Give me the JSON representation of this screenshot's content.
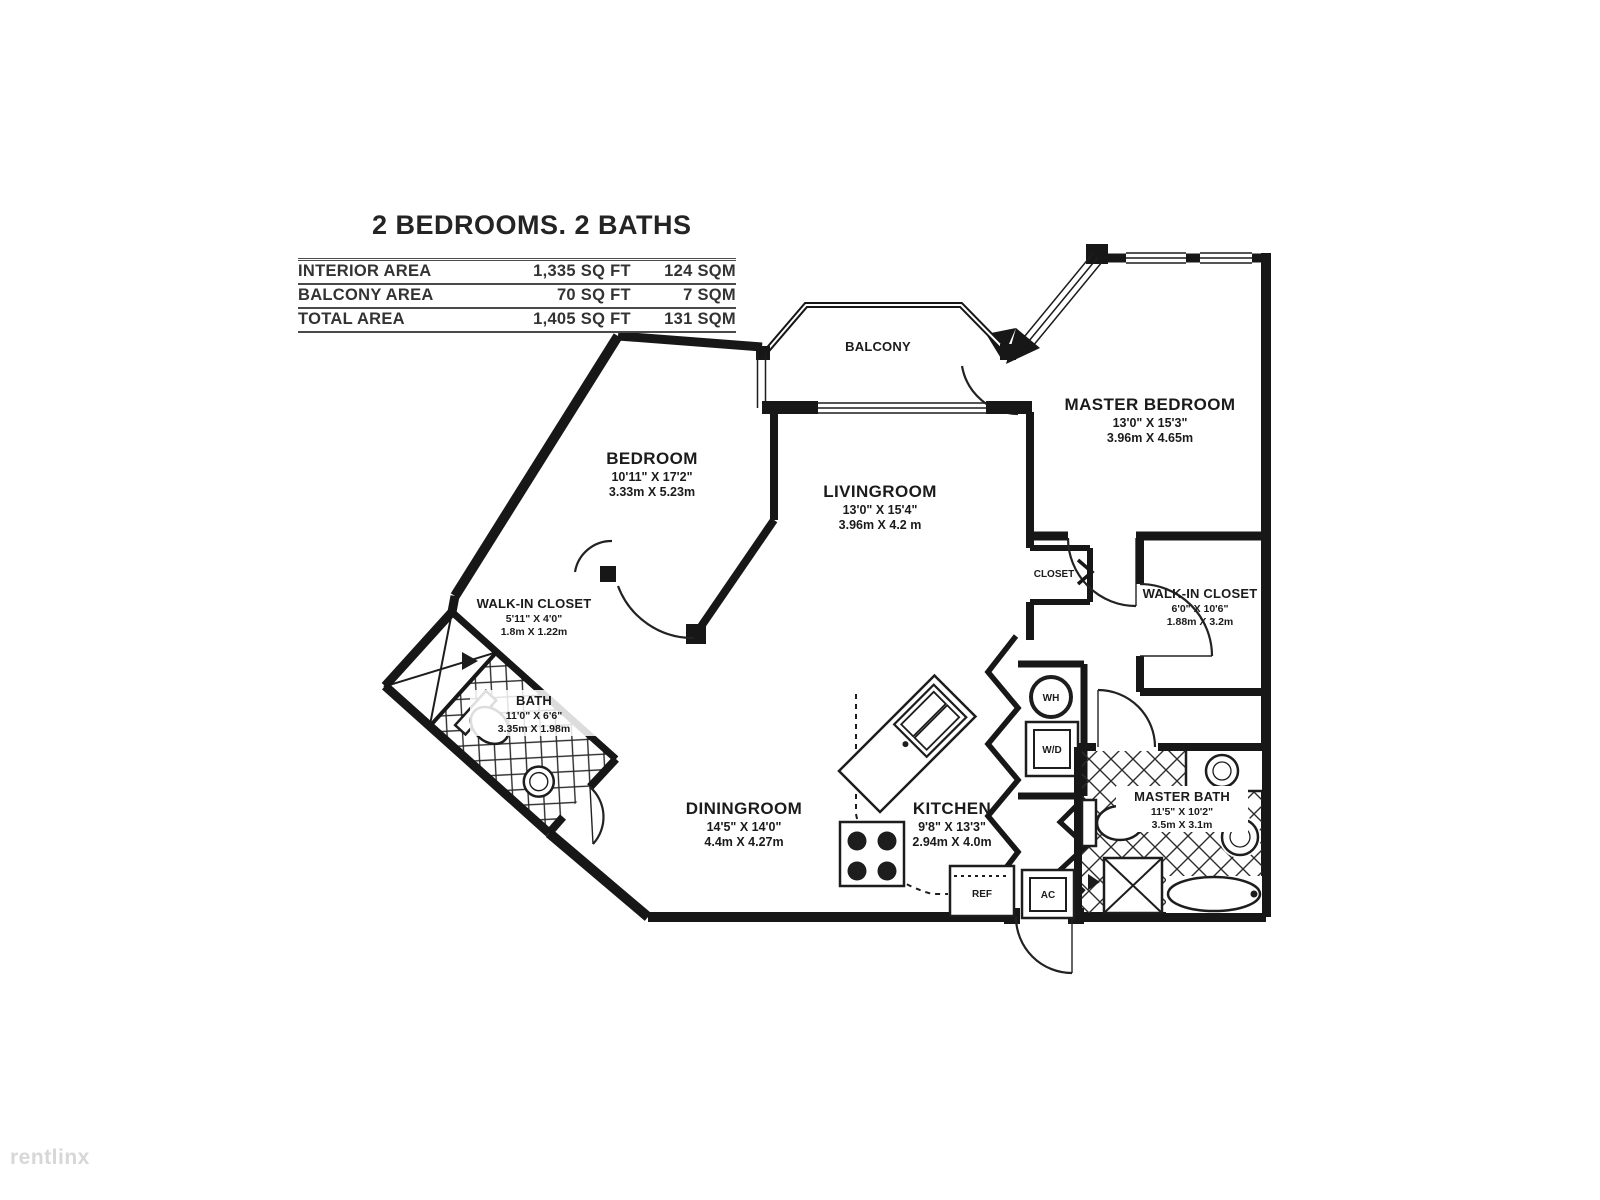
{
  "title": "2 BEDROOMS. 2 BATHS",
  "area_table": {
    "rows": [
      {
        "label": "INTERIOR AREA",
        "sqft": "1,335 SQ FT",
        "sqm": "124 SQM"
      },
      {
        "label": "BALCONY AREA",
        "sqft": "70 SQ FT",
        "sqm": "7 SQM"
      },
      {
        "label": "TOTAL AREA",
        "sqft": "1,405 SQ FT",
        "sqm": "131 SQM"
      }
    ]
  },
  "rooms": {
    "balcony": {
      "name": "BALCONY"
    },
    "bedroom": {
      "name": "BEDROOM",
      "dims_ft": "10'11\" X 17'2\"",
      "dims_m": "3.33m X 5.23m"
    },
    "livingroom": {
      "name": "LIVINGROOM",
      "dims_ft": "13'0\" X 15'4\"",
      "dims_m": "3.96m X 4.2 m"
    },
    "master_bedroom": {
      "name": "MASTER BEDROOM",
      "dims_ft": "13'0\" X 15'3\"",
      "dims_m": "3.96m X 4.65m"
    },
    "walkin_closet_left": {
      "name": "WALK-IN CLOSET",
      "dims_ft": "5'11\" X 4'0\"",
      "dims_m": "1.8m X 1.22m"
    },
    "bath": {
      "name": "BATH",
      "dims_ft": "11'0\" X 6'6\"",
      "dims_m": "3.35m X 1.98m"
    },
    "diningroom": {
      "name": "DININGROOM",
      "dims_ft": "14'5\" X 14'0\"",
      "dims_m": "4.4m X 4.27m"
    },
    "kitchen": {
      "name": "KITCHEN",
      "dims_ft": "9'8\" X 13'3\"",
      "dims_m": "2.94m X 4.0m"
    },
    "walkin_closet_right": {
      "name": "WALK-IN CLOSET",
      "dims_ft": "6'0\" X 10'6\"",
      "dims_m": "1.88m X 3.2m"
    },
    "master_bath": {
      "name": "MASTER BATH",
      "dims_ft": "11'5\" X 10'2\"",
      "dims_m": "3.5m X 3.1m"
    },
    "closet": {
      "name": "CLOSET"
    }
  },
  "appliances": {
    "water_heater": "WH",
    "washer_dryer": "W/D",
    "refrigerator": "REF",
    "air_conditioner": "AC"
  },
  "watermark": "rentlinx",
  "colors": {
    "wall": "#171717",
    "background": "#ffffff",
    "watermark": "#d7d7d7"
  }
}
